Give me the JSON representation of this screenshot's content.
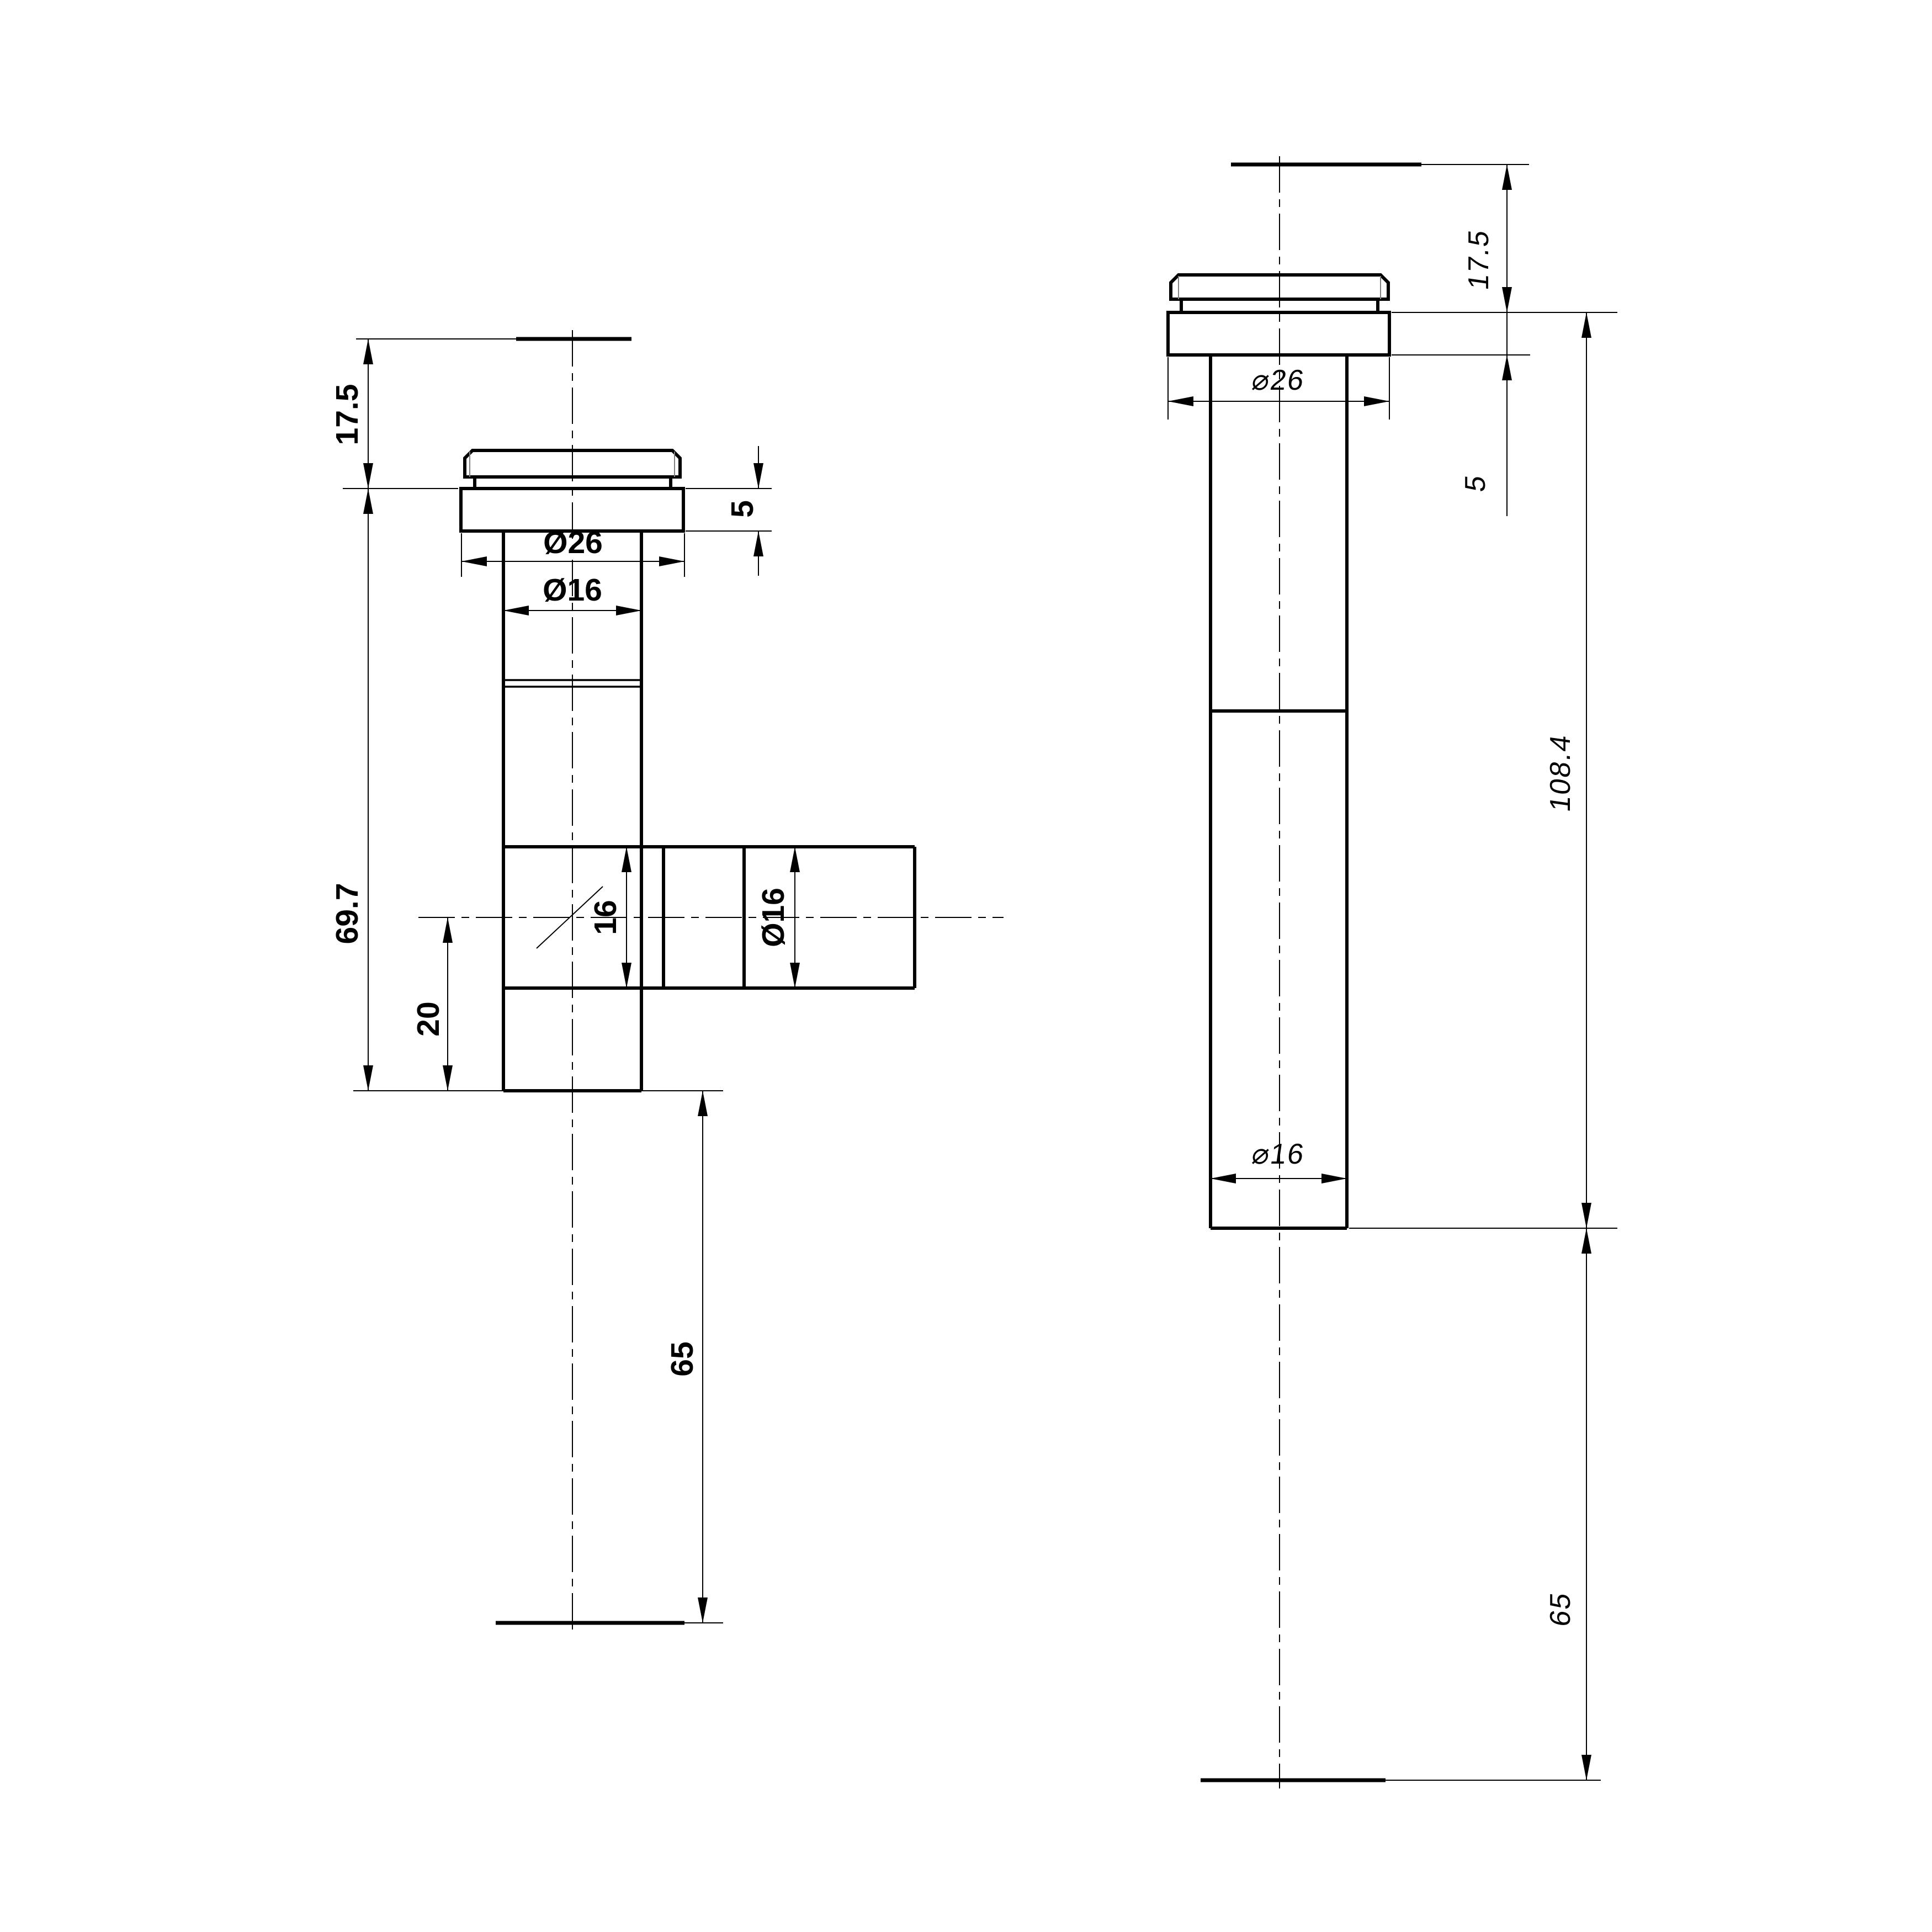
{
  "style": {
    "paper_color": "#ffffff",
    "ink_color": "#000000",
    "chamfer_line_color": "#808080"
  },
  "left_view": {
    "dims": {
      "top_offset": "17.5",
      "flange_height": "5",
      "flange_dia": "Ø26",
      "body_dia": "Ø16",
      "body_length": "69.7",
      "branch_bore": "16",
      "branch_dia": "Ø16",
      "branch_offset": "20",
      "tail_length": "65"
    }
  },
  "right_view": {
    "dims": {
      "top_offset": "17.5",
      "flange_height": "5",
      "flange_dia": "⌀26",
      "total_length": "108.4",
      "body_dia": "⌀16",
      "tail_length": "65"
    }
  }
}
